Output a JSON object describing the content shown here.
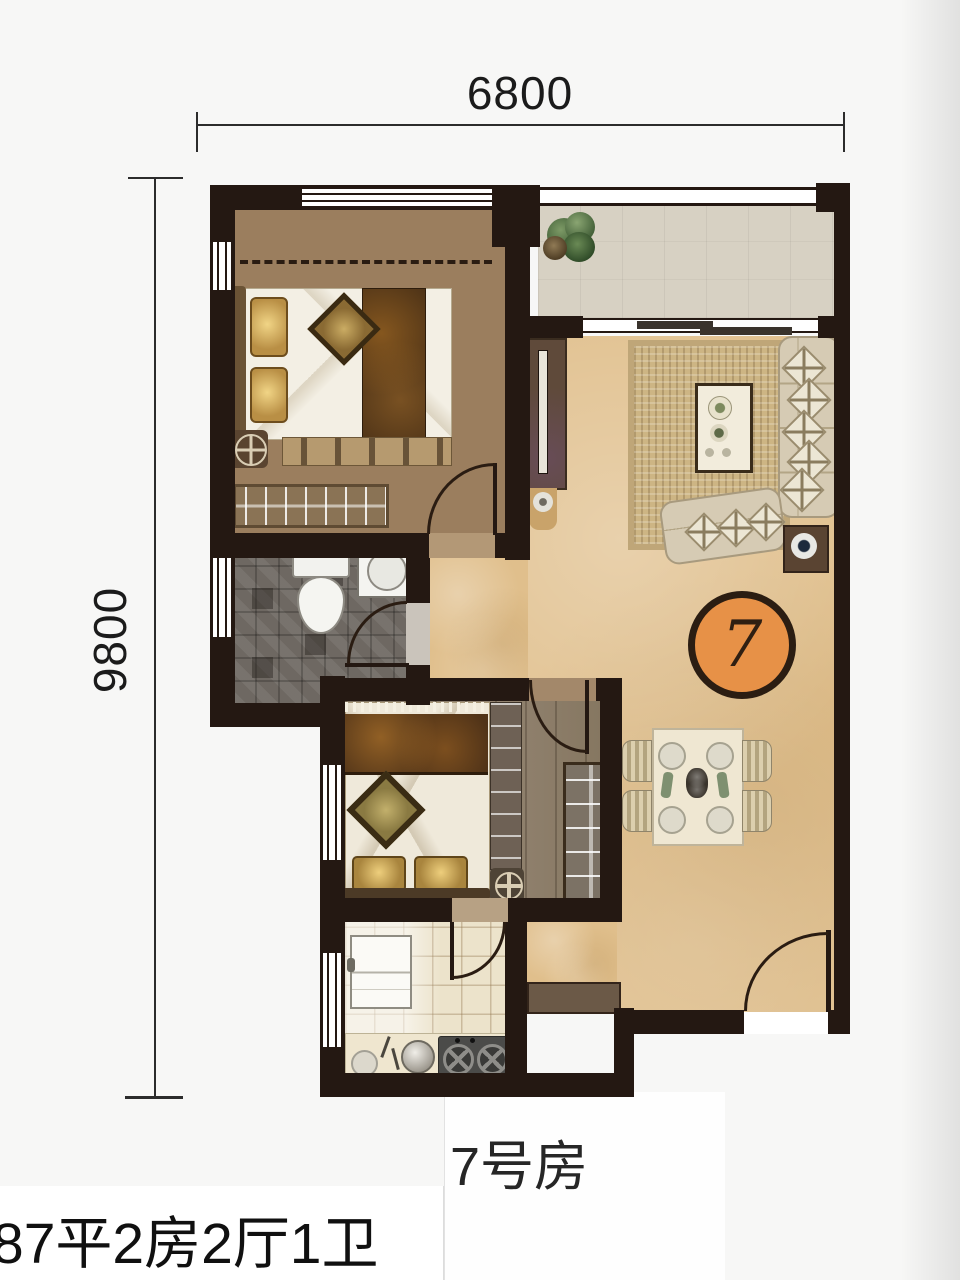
{
  "dimension_labels": {
    "top": "6800",
    "left": "9800"
  },
  "unit_badge": {
    "number": "7"
  },
  "captions": {
    "unit_name": "7号房",
    "unit_spec": "87平2房2厅1卫"
  },
  "colors": {
    "wall": "#241812",
    "badge_fill": "#e79147",
    "badge_ring": "#2b1d12",
    "bedroom_wood": "#9b7e5e",
    "living_floor": "#e0bf8c",
    "bathroom_tile": "#6e6862",
    "balcony_floor": "#d7d1c3",
    "kitchen_tile": "#ece3cb",
    "rug": "#cdb584",
    "sofa": "#d6cbb4",
    "dim_text": "#1b1b1b"
  }
}
